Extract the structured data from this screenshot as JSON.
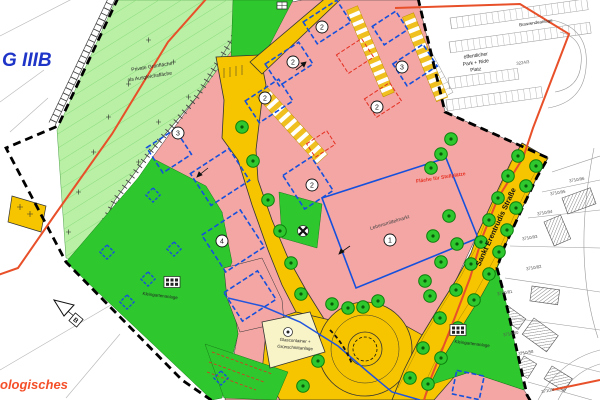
{
  "labels": {
    "zone_g3b": "G IIIB",
    "private_green_1": "Private Grünfläche",
    "private_green_2": "als Ausgleichsfläche",
    "bus_turnaround": "Buswendeanlage",
    "park_ride_1": "öffentlicher",
    "park_ride_2": "Park + Ride",
    "park_ride_3": "Platz",
    "supermarket": "Lebensmittelmarkt",
    "stellplaetze": "Fläche für Stellplätze",
    "street_name": "Sankt Erentrudis Straße",
    "allotment_west": "Kleingartenanlage",
    "allotment_east": "Kleingartenanlage",
    "glass_1": "Glascontainer +",
    "glass_2": "Grünschnittanlage",
    "archaeo_fragment": "ologisches",
    "section_b": "B"
  },
  "markers": [
    {
      "n": "2"
    },
    {
      "n": "2"
    },
    {
      "n": "2"
    },
    {
      "n": "2"
    },
    {
      "n": "3"
    },
    {
      "n": "2"
    },
    {
      "n": "3"
    },
    {
      "n": "4"
    },
    {
      "n": "1"
    }
  ],
  "parcels": [
    {
      "label": "3224/3"
    },
    {
      "label": "3710/96"
    },
    {
      "label": "3710/95"
    },
    {
      "label": "3710/94"
    },
    {
      "label": "3710/93"
    },
    {
      "label": "3710/82"
    },
    {
      "label": "3710/81"
    },
    {
      "label": "3710/80"
    },
    {
      "label": "3710/58"
    },
    {
      "label": "3710/4"
    }
  ],
  "colors": {
    "building_land_pink": "#f3a6a4",
    "public_green": "#2ec82e",
    "private_green_hatched": "#baefa6",
    "road_yellow": "#f6c500",
    "utility_cream": "#f8f4c8",
    "construction_window_blue": "#1550dd",
    "plan_boundary_red": "#e8502a",
    "zone_label_blue": "#1f35c8",
    "note_red": "#e53022"
  }
}
